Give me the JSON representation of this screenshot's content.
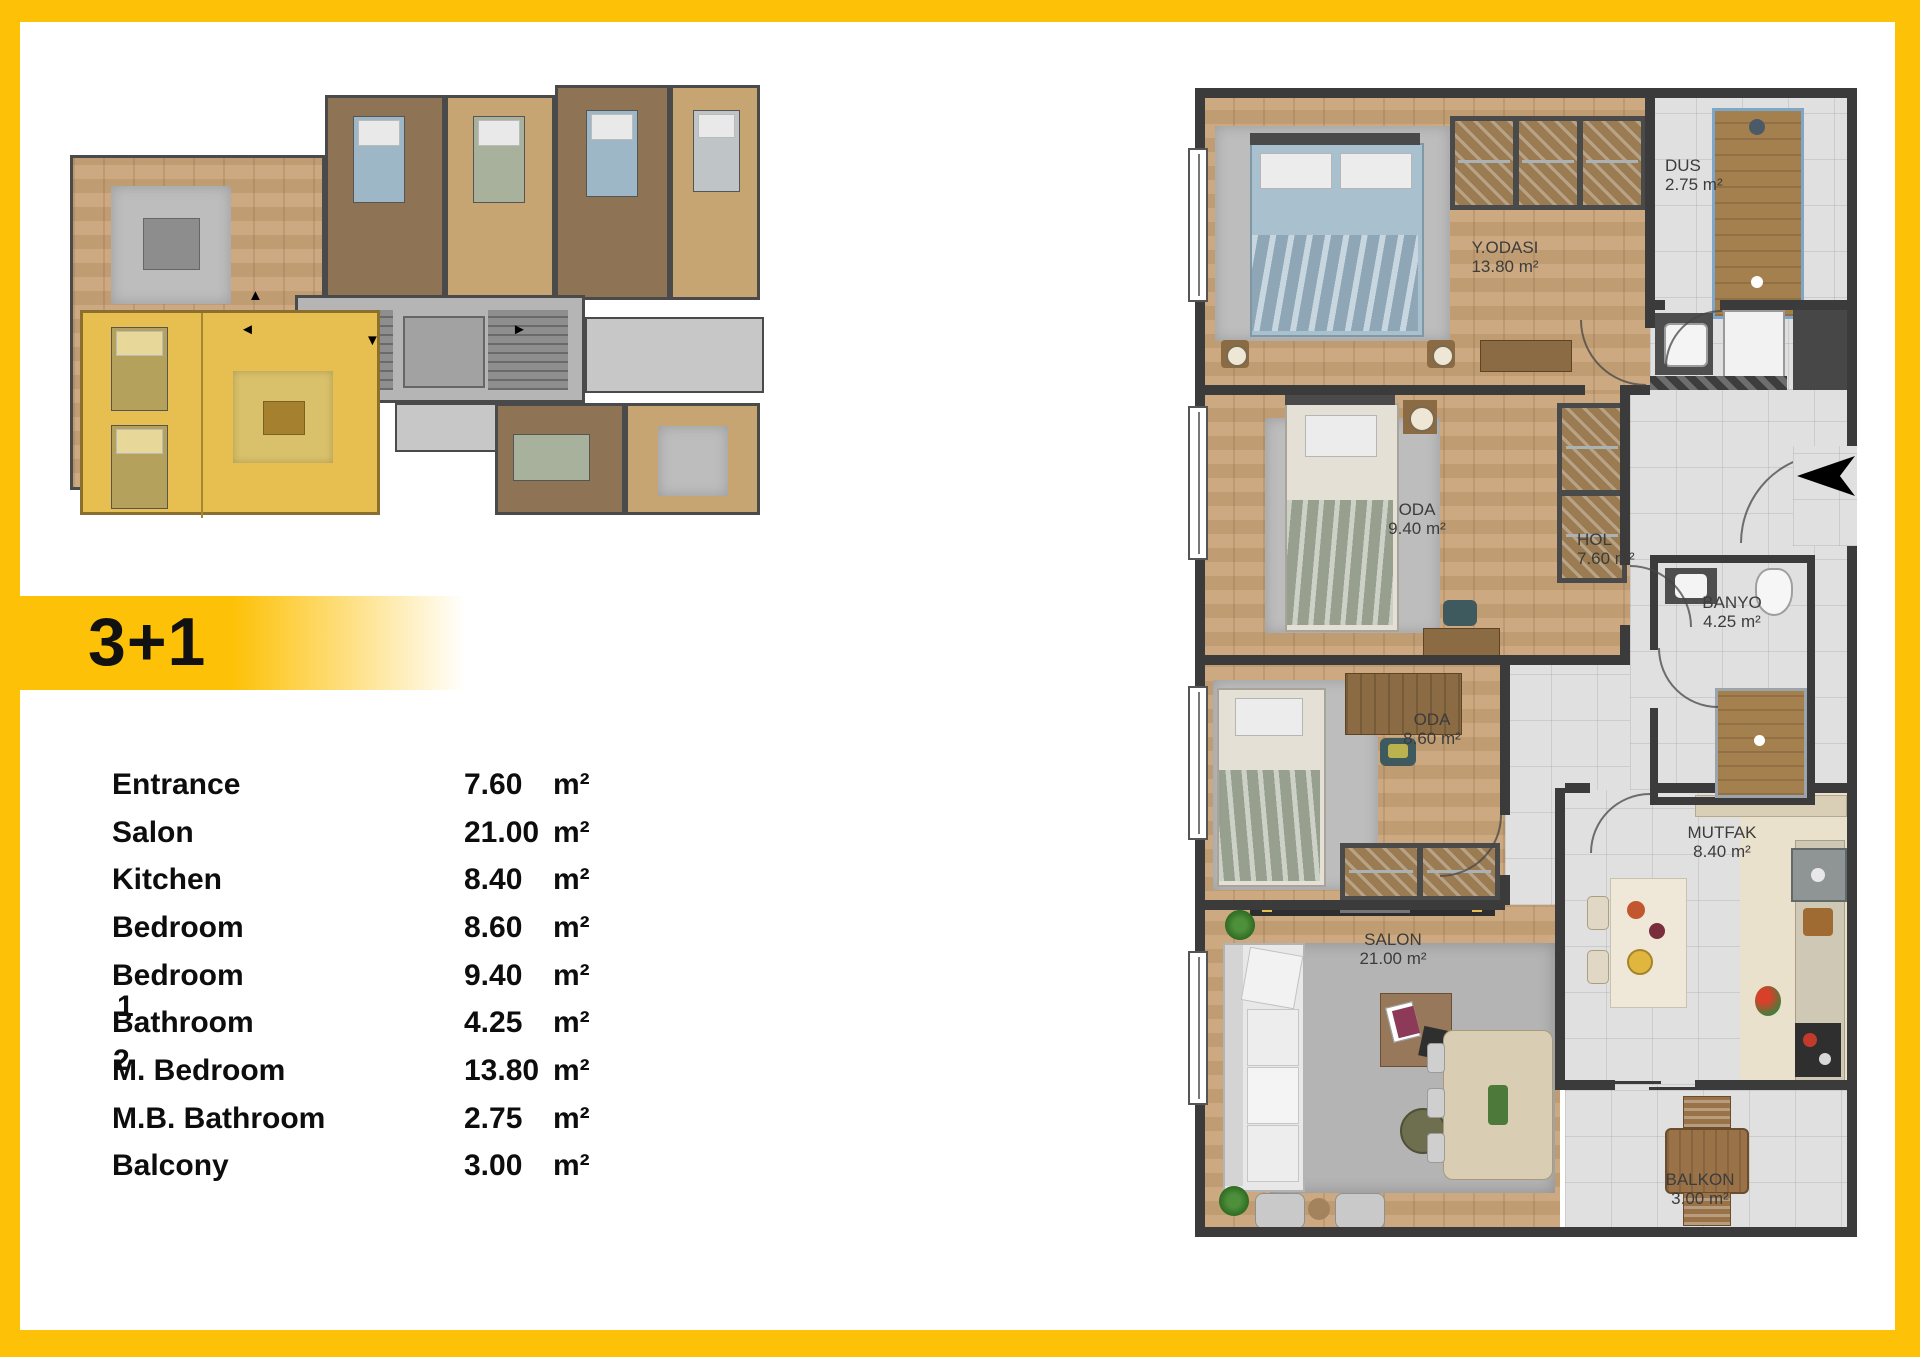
{
  "unit_badge": {
    "label": "3+1"
  },
  "room_table": {
    "rows": [
      {
        "name": "Entrance",
        "value": "7.60",
        "unit": "m²"
      },
      {
        "name": "Salon",
        "value": "21.00",
        "unit": "m²"
      },
      {
        "name": "Kitchen",
        "value": "8.40",
        "unit": "m²"
      },
      {
        "name": "Bedroom",
        "value": "8.60",
        "unit": "m²"
      },
      {
        "name": "Bedroom",
        "value": "9.40",
        "unit": "m²"
      },
      {
        "name": "Bathroom",
        "value": "4.25",
        "unit": "m²"
      },
      {
        "name": "M. Bedroom",
        "value": "13.80",
        "unit": "m²"
      },
      {
        "name": "M.B. Bathroom",
        "value": "2.75",
        "unit": "m²"
      },
      {
        "name": "Balcony",
        "value": "3.00",
        "unit": "m²"
      }
    ],
    "stray_digits": [
      {
        "glyph": "1"
      },
      {
        "glyph": "2"
      }
    ]
  },
  "floor_plan": {
    "rooms": [
      {
        "name": "Y.ODASI",
        "area": "13.80 m²"
      },
      {
        "name": "DUS",
        "area": "2.75 m²"
      },
      {
        "name": "ODA",
        "area": "9.40 m²"
      },
      {
        "name": "HOL",
        "area": "7.60 m²"
      },
      {
        "name": "BANYO",
        "area": "4.25 m²"
      },
      {
        "name": "ODA",
        "area": "8.60 m²"
      },
      {
        "name": "MUTFAK",
        "area": "8.40 m²"
      },
      {
        "name": "SALON",
        "area": "21.00 m²"
      },
      {
        "name": "BALKON",
        "area": "3.00 m²"
      }
    ]
  },
  "colors": {
    "frame_yellow": "#FDC107",
    "plan_wall": "#3B3B3B",
    "wood_floor": "#C9A478",
    "tile_floor": "#E0E0E0",
    "highlighted_unit": "#E6BF50",
    "bed_blue": "#A9C0CE",
    "bed_green": "#ABB3A2"
  }
}
